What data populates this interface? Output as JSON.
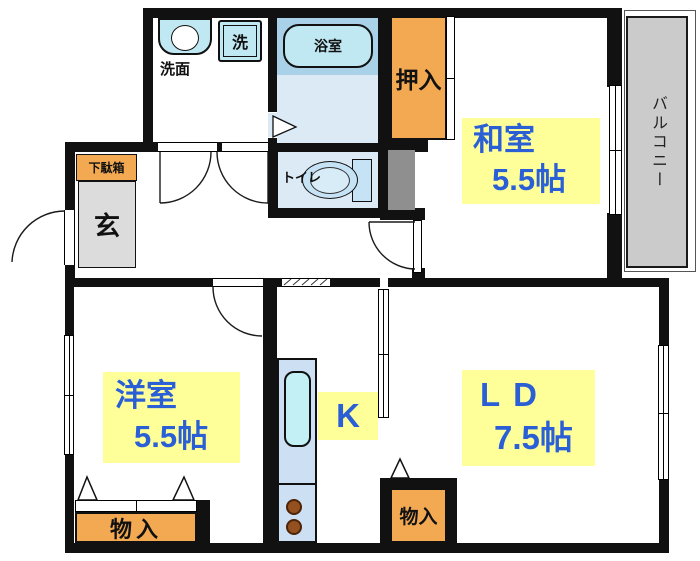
{
  "title": "2LDK floor plan",
  "rooms": {
    "washitsu": {
      "name": "和室",
      "size": "5.5帖"
    },
    "yoshitsu": {
      "name": "洋室",
      "size": "5.5帖"
    },
    "living_dining": {
      "name": "LD",
      "size": "7.5帖"
    },
    "kitchen": {
      "name": "K"
    }
  },
  "fixtures": {
    "washroom_label": "洗面",
    "washer_label": "洗",
    "bath_label": "浴室",
    "toilet_label": "トイレ"
  },
  "storage": {
    "shoe_cabinet_label": "下駄箱",
    "entrance_label": "玄",
    "closet_label": "押入",
    "storage_west_label": "物入",
    "storage_east_label": "物入"
  },
  "balcony": {
    "label": "バルコニー"
  },
  "colors": {
    "label_bg": "#FFFF9A",
    "label_text": "#2A5FD6",
    "storage_orange": "#F2A952",
    "entrance_gray": "#DCDCDC",
    "balcony_gray": "#CBCBCB",
    "pipe_space_gray": "#8F8F8F",
    "bath_band_blue": "#A9D1E8",
    "wet_floor_blue": "#DCEAF6",
    "fixture_blue": "#C6E2F5",
    "counter_blue": "#CCDFF3",
    "wall_black": "#111111",
    "burner_brown": "#94511F"
  }
}
